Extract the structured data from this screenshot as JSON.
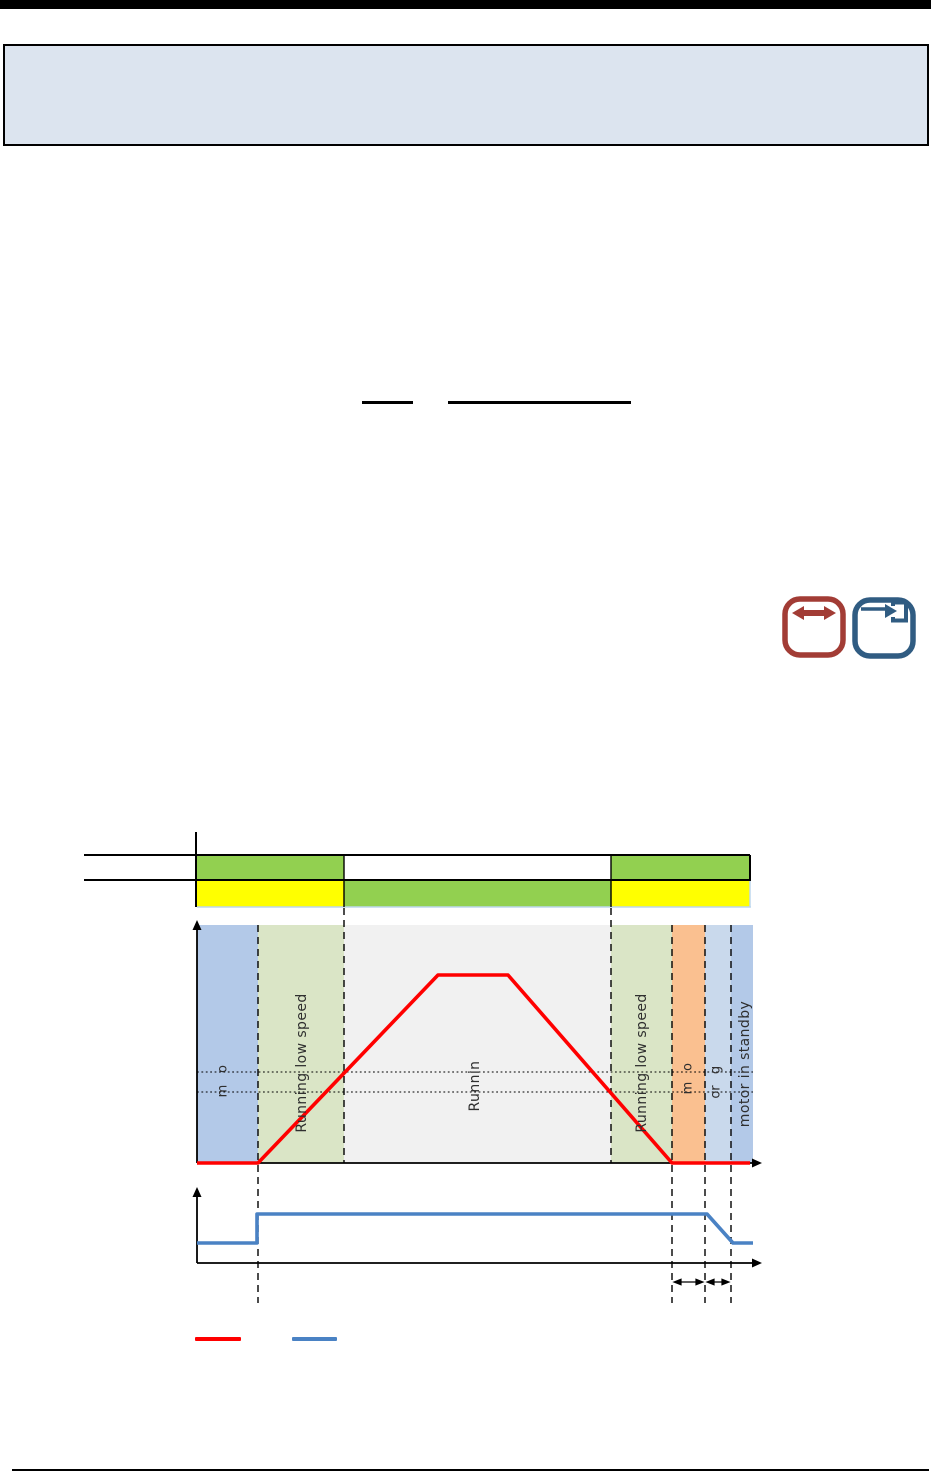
{
  "page": {
    "background": "#ffffff",
    "top_rule_color": "#000000",
    "footer_rule_color": "#000000",
    "info_box": {
      "fill": "#dce4ef",
      "border_color": "#000000",
      "text": ""
    }
  },
  "icons": {
    "double_arrow": {
      "meaning": "horizontal-double-arrow",
      "color": "#a23c35"
    },
    "enter": {
      "meaning": "arrow-into-bracket",
      "color": "#305c82"
    }
  },
  "status_bars": {
    "row1_segments": [
      {
        "color": "#92d050"
      },
      {
        "color": "#ffffff"
      },
      {
        "color": "#92d050"
      }
    ],
    "row2_segments": [
      {
        "color": "#ffff00"
      },
      {
        "color": "#92d050"
      },
      {
        "color": "#ffff00"
      }
    ]
  },
  "diagram": {
    "regions": [
      {
        "color": "#b3c9e8",
        "fragments": [
          {
            "text": "o"
          },
          {
            "text": "m"
          }
        ]
      },
      {
        "color": "#dae5c6",
        "label": "Running low speed"
      },
      {
        "color": "#f1f1f1",
        "label": "Runnin"
      },
      {
        "color": "#dae5c6",
        "label": "Running low speed"
      },
      {
        "color": "#fac090",
        "fragments": [
          {
            "text": "o"
          },
          {
            "text": "m"
          }
        ]
      },
      {
        "color": "#c9d9ec",
        "fragments": [
          {
            "text": "g"
          },
          {
            "text": "or"
          }
        ]
      },
      {
        "color": "#b3c9e8",
        "label": "motor in standby"
      }
    ]
  },
  "legend": {
    "red_swatch_color": "#ff0000",
    "blue_swatch_color": "#4a82c4"
  },
  "chart_data": [
    {
      "type": "line",
      "name": "motor-speed-profile",
      "color": "#ff0000",
      "description": "Motor speed vs time: zero, ramp up through low-speed band, full-speed plateau, ramp down, zero",
      "points_str": "197,1163 258,1163 438,975 508,975 672,1163 750,1163",
      "reference_lines_y": [
        1072,
        1092
      ],
      "region_boundaries_x": [
        197,
        258,
        344,
        611,
        672,
        705,
        731,
        753
      ]
    },
    {
      "type": "step",
      "name": "start-stop-signal",
      "color": "#4a82c4",
      "description": "Digital start/stop signal: low, step high at start, high during run, ramp low at stop",
      "points_str": "197,1243 257,1243 257,1214 707,1214 733,1243 753,1243",
      "dimension_arrows_x": [
        [
          674,
          703
        ],
        [
          707,
          729
        ]
      ]
    }
  ]
}
